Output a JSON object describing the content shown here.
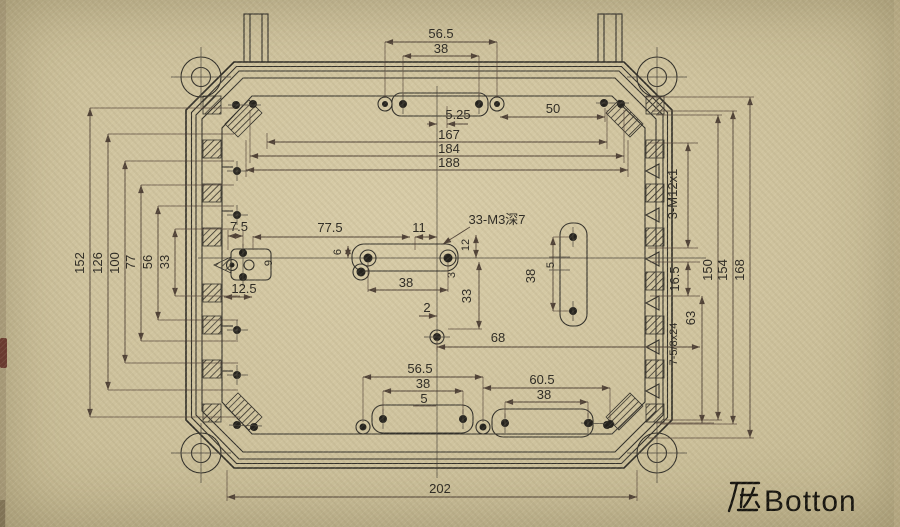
{
  "colors": {
    "paper": "#cfc39e",
    "line": "#32302a",
    "dimension": "#4f4136"
  },
  "drawing": {
    "caption_cn": "底",
    "caption_en": "Botton",
    "dims_top": {
      "w56_5": "56.5",
      "w38": "38",
      "w5_25": "5.25",
      "w50": "50",
      "w167": "167",
      "w184": "184",
      "w188": "188"
    },
    "dims_left": {
      "h152": "152",
      "h126": "126",
      "h100": "100",
      "h77": "77",
      "h56": "56",
      "h33": "33"
    },
    "left_boss": {
      "d7_5": "7.5",
      "d12_5": "12.5",
      "d9": "9"
    },
    "center": {
      "d77_5": "77.5",
      "d11": "11",
      "m3_callout": "33-M3深7",
      "d12": "12",
      "d3": "3",
      "d38": "38",
      "d6": "6",
      "d2": "2",
      "d33": "33",
      "d68": "68"
    },
    "mid_right_slot": {
      "d38": "38",
      "d5": "5"
    },
    "dims_right": {
      "m12_callout": "3-M12x1",
      "d16_5": "16.5",
      "d63": "63",
      "gland_callout": "7-5/8x24",
      "h150": "150",
      "h154": "154",
      "h168": "168"
    },
    "dims_bottom": {
      "w56_5": "56.5",
      "w38_left": "38",
      "w5": "5",
      "w60_5": "60.5",
      "w38_right": "38",
      "w202": "202"
    }
  }
}
